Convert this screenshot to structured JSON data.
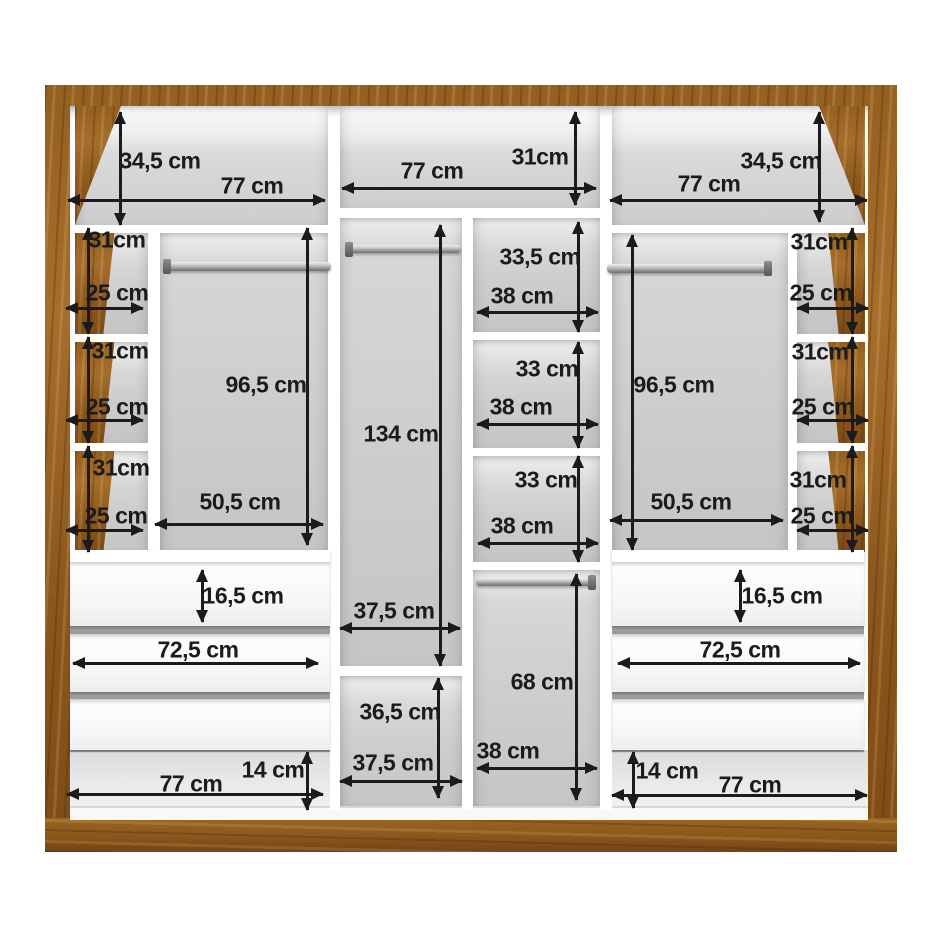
{
  "diagram": {
    "subject": "wardrobe-interior-dimension-diagram",
    "unit": "cm"
  },
  "colors": {
    "wood": "#94601f",
    "wood_dark": "#7d4b16",
    "compartment_back": "#cccccc",
    "panel_white": "#ffffff",
    "dimension_line": "#1b1b1b",
    "rail_metal": "#84888b"
  },
  "sections": {
    "top_shelves": [
      {
        "width": "77 cm",
        "height": "34,5 cm"
      },
      {
        "width": "77 cm",
        "height": "31cm"
      },
      {
        "width": "77 cm",
        "height": "34,5 cm"
      }
    ],
    "side_columns": {
      "section_height": "31cm",
      "column_width": "25 cm",
      "sections_per_side": 3
    },
    "main_hanging_compartments": {
      "height": "96,5 cm",
      "width": "50,5 cm"
    },
    "middle_column": {
      "height": "134 cm",
      "width": "37,5 cm",
      "lower_section_height": "36,5 cm",
      "lower_section_width": "37,5 cm"
    },
    "center_column": [
      {
        "height": "33,5 cm",
        "width": "38 cm"
      },
      {
        "height": "33 cm",
        "width": "38 cm"
      },
      {
        "height": "33 cm",
        "width": "38 cm"
      },
      {
        "height": "68 cm",
        "width": "38 cm"
      }
    ],
    "drawers": {
      "drawer_height": "16,5 cm",
      "drawer_width": "72,5 cm",
      "drawers_per_side": 3
    },
    "base": {
      "height": "14 cm",
      "width": "77 cm"
    }
  },
  "annotations": {
    "arrows": [
      {
        "dir": "v",
        "x": 120,
        "y": 112,
        "len": 113
      },
      {
        "dir": "h",
        "x": 68,
        "y": 200,
        "len": 257
      },
      {
        "dir": "h",
        "x": 342,
        "y": 188,
        "len": 254
      },
      {
        "dir": "v",
        "x": 575,
        "y": 112,
        "len": 93
      },
      {
        "dir": "v",
        "x": 819,
        "y": 112,
        "len": 110
      },
      {
        "dir": "h",
        "x": 610,
        "y": 200,
        "len": 257
      },
      {
        "dir": "v",
        "x": 88,
        "y": 228,
        "len": 106
      },
      {
        "dir": "h",
        "x": 66,
        "y": 308,
        "len": 77
      },
      {
        "dir": "v",
        "x": 88,
        "y": 337,
        "len": 106
      },
      {
        "dir": "h",
        "x": 66,
        "y": 420,
        "len": 77
      },
      {
        "dir": "v",
        "x": 88,
        "y": 446,
        "len": 106
      },
      {
        "dir": "h",
        "x": 66,
        "y": 530,
        "len": 77
      },
      {
        "dir": "v",
        "x": 307,
        "y": 228,
        "len": 317
      },
      {
        "dir": "h",
        "x": 155,
        "y": 524,
        "len": 168
      },
      {
        "dir": "v",
        "x": 440,
        "y": 225,
        "len": 441
      },
      {
        "dir": "h",
        "x": 340,
        "y": 628,
        "len": 120
      },
      {
        "dir": "v",
        "x": 438,
        "y": 678,
        "len": 120
      },
      {
        "dir": "h",
        "x": 340,
        "y": 781,
        "len": 122
      },
      {
        "dir": "v",
        "x": 578,
        "y": 222,
        "len": 110
      },
      {
        "dir": "h",
        "x": 477,
        "y": 312,
        "len": 121
      },
      {
        "dir": "v",
        "x": 578,
        "y": 342,
        "len": 106
      },
      {
        "dir": "h",
        "x": 477,
        "y": 424,
        "len": 121
      },
      {
        "dir": "v",
        "x": 578,
        "y": 456,
        "len": 106
      },
      {
        "dir": "h",
        "x": 478,
        "y": 543,
        "len": 120
      },
      {
        "dir": "v",
        "x": 576,
        "y": 574,
        "len": 226
      },
      {
        "dir": "h",
        "x": 477,
        "y": 768,
        "len": 120
      },
      {
        "dir": "v",
        "x": 632,
        "y": 235,
        "len": 315
      },
      {
        "dir": "h",
        "x": 610,
        "y": 520,
        "len": 173
      },
      {
        "dir": "v",
        "x": 852,
        "y": 228,
        "len": 106
      },
      {
        "dir": "h",
        "x": 797,
        "y": 308,
        "len": 71
      },
      {
        "dir": "v",
        "x": 852,
        "y": 337,
        "len": 106
      },
      {
        "dir": "h",
        "x": 797,
        "y": 420,
        "len": 71
      },
      {
        "dir": "v",
        "x": 852,
        "y": 446,
        "len": 106
      },
      {
        "dir": "h",
        "x": 797,
        "y": 530,
        "len": 71
      },
      {
        "dir": "v",
        "x": 202,
        "y": 570,
        "len": 52
      },
      {
        "dir": "h",
        "x": 73,
        "y": 663,
        "len": 245
      },
      {
        "dir": "v",
        "x": 740,
        "y": 570,
        "len": 52
      },
      {
        "dir": "h",
        "x": 618,
        "y": 663,
        "len": 242
      },
      {
        "dir": "v",
        "x": 307,
        "y": 752,
        "len": 58
      },
      {
        "dir": "h",
        "x": 67,
        "y": 794,
        "len": 256
      },
      {
        "dir": "v",
        "x": 633,
        "y": 752,
        "len": 56
      },
      {
        "dir": "h",
        "x": 612,
        "y": 795,
        "len": 255
      }
    ],
    "labels": [
      {
        "text": "34,5 cm",
        "x": 160,
        "y": 161
      },
      {
        "text": "77 cm",
        "x": 252,
        "y": 186
      },
      {
        "text": "77 cm",
        "x": 432,
        "y": 171
      },
      {
        "text": "31cm",
        "x": 540,
        "y": 157
      },
      {
        "text": "34,5 cm",
        "x": 781,
        "y": 161
      },
      {
        "text": "77 cm",
        "x": 709,
        "y": 184
      },
      {
        "text": "31cm",
        "x": 117,
        "y": 240
      },
      {
        "text": "25 cm",
        "x": 117,
        "y": 293
      },
      {
        "text": "31cm",
        "x": 120,
        "y": 351
      },
      {
        "text": "25 cm",
        "x": 117,
        "y": 407
      },
      {
        "text": "31cm",
        "x": 121,
        "y": 468
      },
      {
        "text": "25 cm",
        "x": 116,
        "y": 516
      },
      {
        "text": "96,5 cm",
        "x": 266,
        "y": 385
      },
      {
        "text": "50,5 cm",
        "x": 240,
        "y": 502
      },
      {
        "text": "134 cm",
        "x": 401,
        "y": 434
      },
      {
        "text": "37,5 cm",
        "x": 394,
        "y": 611
      },
      {
        "text": "36,5 cm",
        "x": 400,
        "y": 712
      },
      {
        "text": "37,5 cm",
        "x": 393,
        "y": 763
      },
      {
        "text": "33,5 cm",
        "x": 540,
        "y": 257
      },
      {
        "text": "38 cm",
        "x": 522,
        "y": 296
      },
      {
        "text": "33 cm",
        "x": 547,
        "y": 369
      },
      {
        "text": "38 cm",
        "x": 521,
        "y": 407
      },
      {
        "text": "33 cm",
        "x": 546,
        "y": 480
      },
      {
        "text": "38 cm",
        "x": 522,
        "y": 526
      },
      {
        "text": "68 cm",
        "x": 542,
        "y": 682
      },
      {
        "text": "38 cm",
        "x": 508,
        "y": 751
      },
      {
        "text": "96,5 cm",
        "x": 674,
        "y": 385
      },
      {
        "text": "50,5 cm",
        "x": 691,
        "y": 502
      },
      {
        "text": "31cm",
        "x": 819,
        "y": 242
      },
      {
        "text": "25 cm",
        "x": 821,
        "y": 293
      },
      {
        "text": "31cm",
        "x": 820,
        "y": 352
      },
      {
        "text": "25 cm",
        "x": 823,
        "y": 407
      },
      {
        "text": "31cm",
        "x": 818,
        "y": 480
      },
      {
        "text": "25 cm",
        "x": 822,
        "y": 516
      },
      {
        "text": "16,5 cm",
        "x": 243,
        "y": 596
      },
      {
        "text": "72,5 cm",
        "x": 198,
        "y": 650
      },
      {
        "text": "16,5 cm",
        "x": 782,
        "y": 596
      },
      {
        "text": "72,5 cm",
        "x": 740,
        "y": 650
      },
      {
        "text": "14 cm",
        "x": 273,
        "y": 770
      },
      {
        "text": "77 cm",
        "x": 191,
        "y": 784
      },
      {
        "text": "14 cm",
        "x": 667,
        "y": 771
      },
      {
        "text": "77 cm",
        "x": 750,
        "y": 785
      }
    ]
  }
}
